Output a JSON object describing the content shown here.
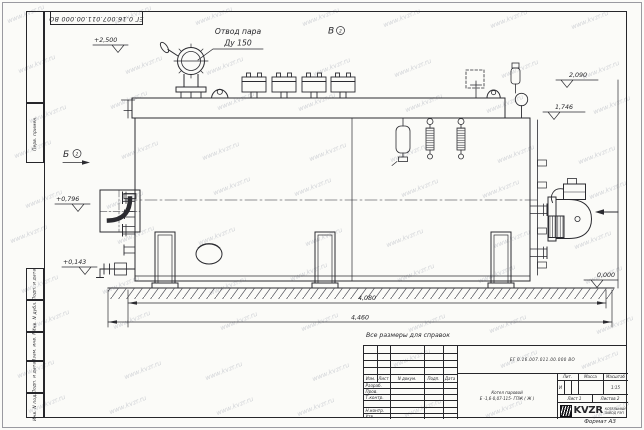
{
  "watermark": {
    "text": "www.kvzr.ru"
  },
  "sheet": {
    "top_stamp_number": "ЕГ 0.16.007.011.00.000  ВО",
    "format_label": "Формат А3",
    "reference_note": "Все размеры для справок",
    "margin_fields": {
      "perv_primen": "Перв. примен.",
      "podp_data_1": "Подп. и дата",
      "inv_dubl": "Инв. N дубл.",
      "vzam_inv": "Взам. инв. N",
      "podp_data_2": "Подп. и дата",
      "inv_podl": "Инв. N подл."
    }
  },
  "drawing": {
    "callout": {
      "line1": "Отвод пара",
      "line2": "Ду 150"
    },
    "views": {
      "b": "Б",
      "b_ref": "2",
      "v": "В",
      "v_ref": "2"
    },
    "elevations": {
      "deck": "+2,500",
      "mid": "+0,796",
      "low": "+0,143",
      "ground": "0,000",
      "top_right": "2,090",
      "body_top": "1,746"
    },
    "dimensions": {
      "inner_length": "4,080",
      "overall_length": "4,460"
    }
  },
  "title_block": {
    "doc_number": "ЕГ 0.16.007.011.00.000  ВО",
    "product_line1": "Котел паровой",
    "product_line2": "Е -1,6-0,07-115- ГПЖ ( Ж )",
    "columns": {
      "izm": "Изм.",
      "list": "Лист",
      "ndoc": "N докум.",
      "podp": "Подп.",
      "data": "Дата"
    },
    "roles": {
      "razrab": "Разраб.",
      "prov": "Пров.",
      "tkontr": "Т.контр.",
      "nkontr": "Н.контр.",
      "utv": "Утв."
    },
    "lit": {
      "header": "Лит.",
      "value": "И"
    },
    "mass": {
      "header": "Масса"
    },
    "scale": {
      "header": "Масштаб",
      "value": "1:15"
    },
    "sheet_info": {
      "sheet": "Лист 1",
      "sheets": "Листов 2"
    },
    "logo": {
      "icon": "spring-coil-icon",
      "brand": "KVZR",
      "company_line1": "КОТЕЛЬНЫЙ",
      "company_line2": "ЗАВОД РЭП"
    }
  }
}
